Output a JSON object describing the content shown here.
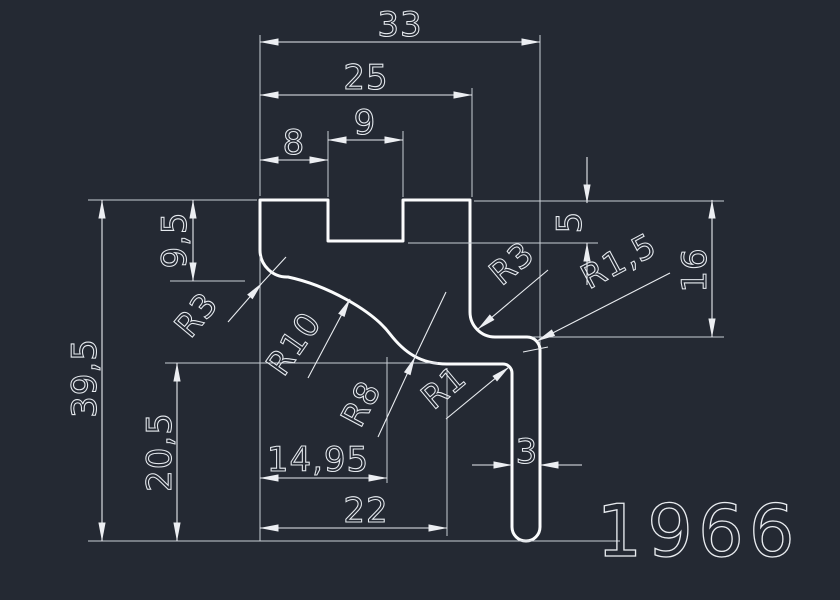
{
  "drawing": {
    "title": "profile-cross-section",
    "part_number": "1966",
    "colors": {
      "background": "#242933",
      "profile_line": "#fbfcfd",
      "dimension_line": "#e9ecf0",
      "text": "#e6eaef"
    },
    "dimensions": {
      "overall_width": "33",
      "top_width": "25",
      "notch_width": "9",
      "notch_offset": "8",
      "step_depth": "9,5",
      "notch_depth": "5",
      "right_height": "16",
      "overall_height": "39,5",
      "lower_height": "20,5",
      "curve_width": "14,95",
      "bottom_width": "22",
      "leg_thickness": "3"
    },
    "radii": {
      "left_fillet": "R3",
      "s_curve_upper": "R10",
      "s_curve_lower": "R8",
      "inner_corner": "R1",
      "right_inner_fillet": "R3",
      "right_outer_fillet": "R1,5"
    }
  }
}
